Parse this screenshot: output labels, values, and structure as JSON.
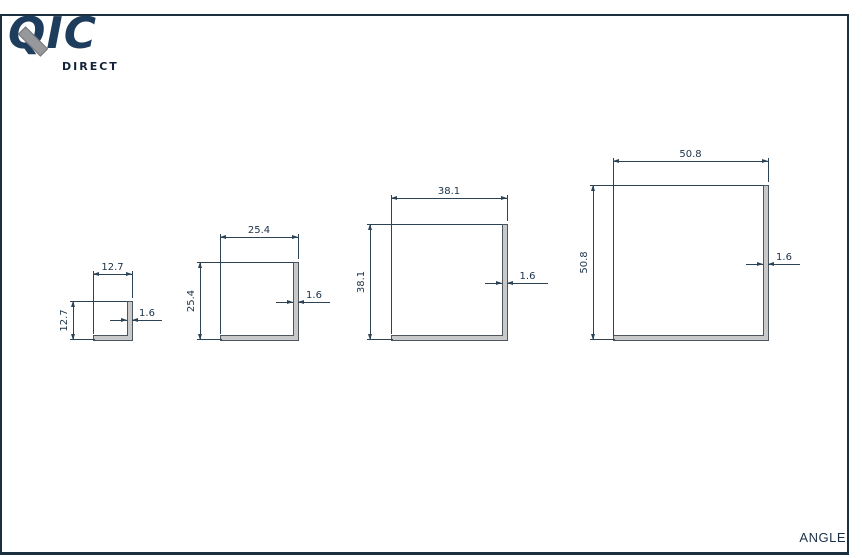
{
  "logo": {
    "text": "QIC",
    "subtext": "DIRECT"
  },
  "sheet": {
    "title": "ANGLE"
  },
  "colors": {
    "frame_border": "#1c2f3f",
    "dimension_line": "#2c4355",
    "dimension_text": "#1b3147",
    "logo_navy": "#1e3c5c",
    "logo_slash_gray": "#97989c",
    "profile_fill": "#c9c9c9",
    "profile_stroke": "#4d565e"
  },
  "diagram": {
    "type": "angle profile cross-sections",
    "thickness_mm": 1.6,
    "sizes_mm": [
      12.7,
      25.4,
      38.1,
      50.8
    ]
  },
  "drawings": [
    {
      "id": "angle-12.7",
      "width_label": "12.7",
      "height_label": "12.7",
      "thickness_label": "1.6"
    },
    {
      "id": "angle-25.4",
      "width_label": "25.4",
      "height_label": "25.4",
      "thickness_label": "1.6"
    },
    {
      "id": "angle-38.1",
      "width_label": "38.1",
      "height_label": "38.1",
      "thickness_label": "1.6"
    },
    {
      "id": "angle-50.8",
      "width_label": "50.8",
      "height_label": "50.8",
      "thickness_label": "1.6"
    }
  ]
}
